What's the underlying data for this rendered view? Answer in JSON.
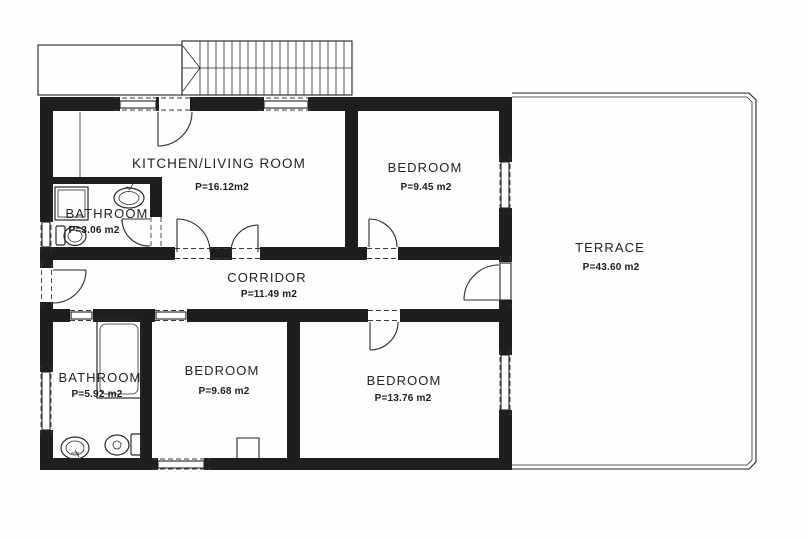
{
  "drawing": {
    "kind_label": "floor plan",
    "colors": {
      "ink": "#1e1e1e",
      "paper": "#fefefe"
    }
  },
  "rooms": [
    {
      "name": "KITCHEN/LIVING ROOM",
      "area": "P=16.12m2"
    },
    {
      "name": "BATHROOM",
      "area": "P=3.06 m2"
    },
    {
      "name": "BEDROOM",
      "area": "P=9.45 m2"
    },
    {
      "name": "CORRIDOR",
      "area": "P=11.49 m2"
    },
    {
      "name": "TERRACE",
      "area": "P=43.60 m2"
    },
    {
      "name": "BATHROOM",
      "area": "P=5.92 m2"
    },
    {
      "name": "BEDROOM",
      "area": "P=9.68 m2"
    },
    {
      "name": "BEDROOM",
      "area": "P=13.76 m2"
    }
  ]
}
